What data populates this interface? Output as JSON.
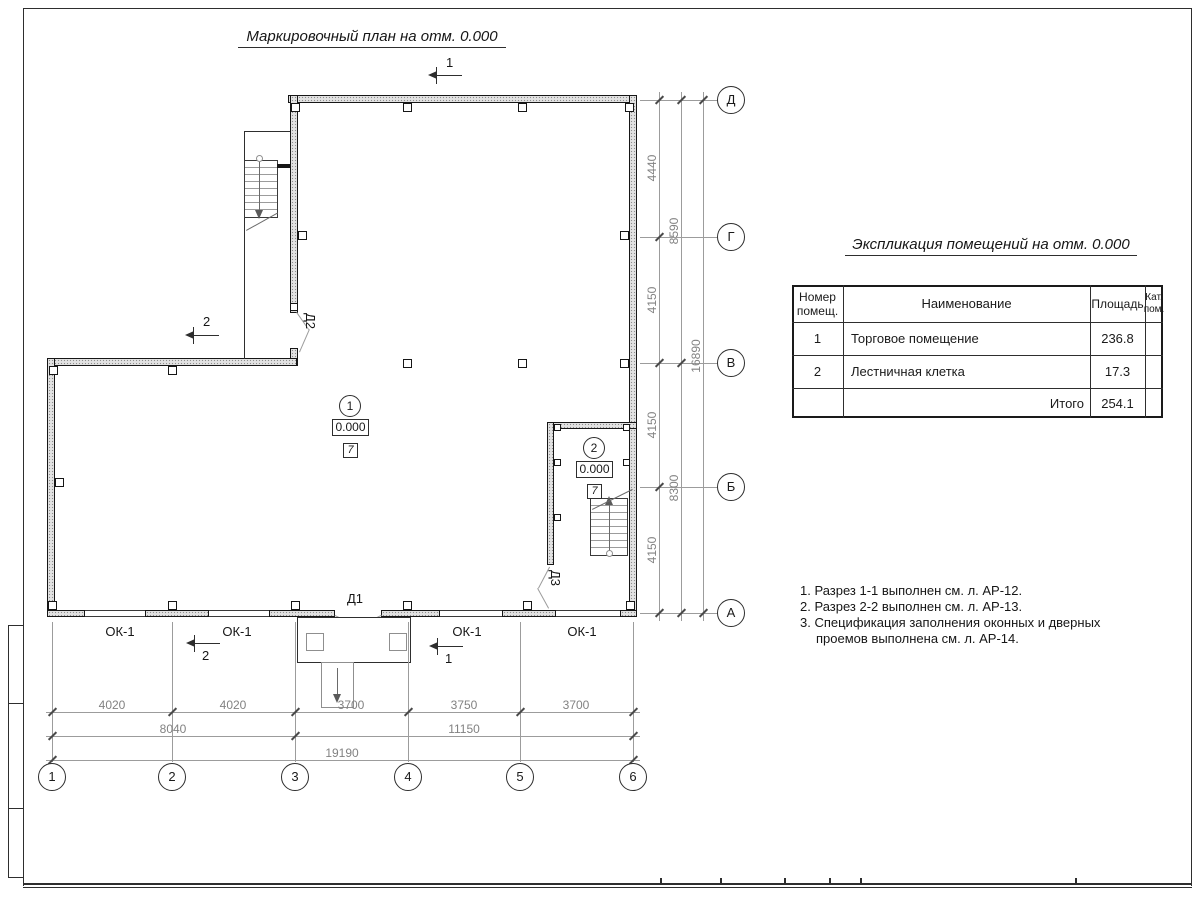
{
  "titles": {
    "plan": "Маркировочный план на отм. 0.000",
    "table": "Экспликация помещений на отм. 0.000"
  },
  "table": {
    "col_num_a": "Номер",
    "col_num_b": "помещ.",
    "col_name": "Наименование",
    "col_area": "Площадь",
    "col_cat_a": "Кат.",
    "col_cat_b": "пом.",
    "rows": [
      {
        "num": "1",
        "name": "Торговое помещение",
        "area": "236.8",
        "cat": ""
      },
      {
        "num": "2",
        "name": "Лестничная клетка",
        "area": "17.3",
        "cat": ""
      }
    ],
    "total_label": "Итого",
    "total_area": "254.1"
  },
  "notes": [
    "1. Разрез 1-1 выполнен см. л. АР-12.",
    "2. Разрез 2-2 выполнен см. л. АР-13.",
    "3. Спецификация заполнения оконных и дверных",
    "проемов выполнена см. л. АР-14."
  ],
  "axes": {
    "cols": [
      "1",
      "2",
      "3",
      "4",
      "5",
      "6"
    ],
    "rows": [
      "Д",
      "Г",
      "В",
      "Б",
      "А"
    ]
  },
  "dims": {
    "b1": [
      "4020",
      "4020",
      "3700",
      "3750",
      "3700"
    ],
    "b2": [
      "8040",
      "11150"
    ],
    "b3": [
      "19190"
    ],
    "r1": [
      "4440",
      "4150",
      "4150",
      "4150"
    ],
    "r2": [
      "8590",
      "8300"
    ],
    "r3": [
      "16890"
    ]
  },
  "marks": {
    "window": "ОК-1",
    "door1": "Д1",
    "door2": "Д2",
    "door3": "Д3",
    "section1": "1",
    "section2": "2"
  },
  "rooms": [
    {
      "num": "1",
      "elev": "0.000",
      "type": "7"
    },
    {
      "num": "2",
      "elev": "0.000",
      "type": "7"
    }
  ]
}
